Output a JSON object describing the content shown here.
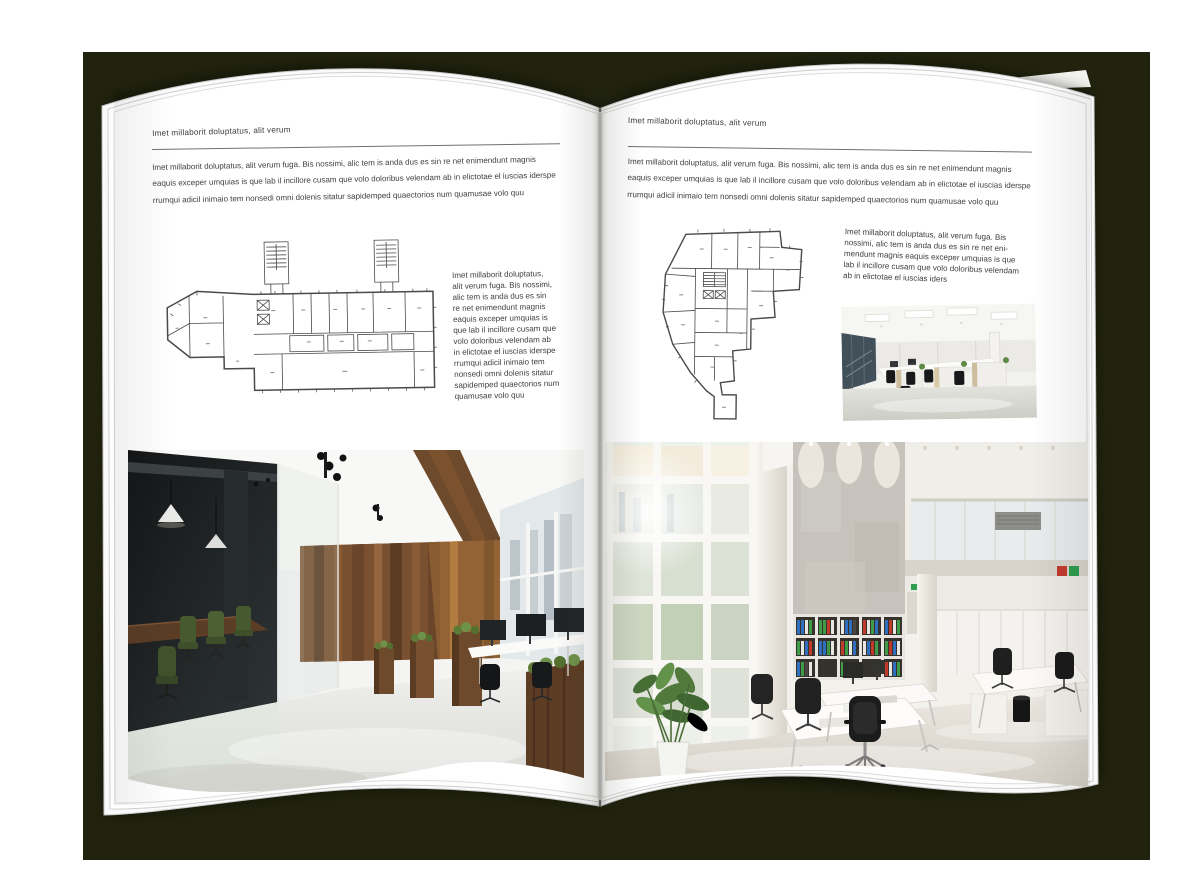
{
  "canvas": {
    "background": "#ffffff"
  },
  "book": {
    "cover_color": "#21230e",
    "page_color": "#ffffff",
    "left_page": {
      "header": "Imet millaborit doluptatus, alit verum",
      "intro_lines": [
        "Imet millaborit doluptatus, alit verum fuga. Bis nossimi, alic tem is anda dus es sin re net enimendunt magnis",
        "eaquis exceper umquias is que lab il incillore cusam que volo doloribus velendam ab in elictotae el iuscias iderspe",
        "rrumqui adicil inimaio tem nonsedi omni dolenis sitatur sapidemped quaectorios num quamusae volo quu"
      ],
      "side_lines": [
        "Imet millaborit doluptatus,",
        "alit verum fuga. Bis nossimi,",
        "alic tem is anda dus es sin",
        "re net enimendunt magnis",
        "eaquis exceper umquias is",
        "que lab il incillore cusam que",
        "volo doloribus velendam ab",
        "in elictotae el iuscias iderspe",
        "rrumqui adicil inimaio tem",
        "nonsedi omni dolenis sitatur",
        "sapidemped quaectorios num",
        "quamusae volo quu"
      ]
    },
    "right_page": {
      "header": "Imet millaborit doluptatus, alit verum",
      "intro_lines": [
        "Imet millaborit doluptatus, alit verum fuga. Bis nossimi, alic tem is anda dus es sin re net enimendunt magnis",
        "eaquis exceper umquias is que lab il incillore cusam que volo doloribus velendam ab in elictotae el iuscias iderspe",
        "rrumqui adicil inimaio tem nonsedi omni dolenis sitatur sapidemped quaectorios num quamusae volo quu"
      ],
      "side_lines": [
        "Imet millaborit doluptatus, alit verum fuga. Bis",
        "nossimi, alic tem is anda dus es sin re net eni-",
        "mendunt magnis eaquis exceper umquias is que",
        "lab il incillore cusam que volo doloribus velendam",
        "ab in elictotae el iuscias iders"
      ]
    },
    "palette": {
      "wood": "#6e4a2c",
      "chair_green": "#47592f",
      "glass_dark": "#1c1f20",
      "concrete": "#c7c3bc",
      "binder_blue": "#2f6fbd",
      "binder_green": "#3f9b48",
      "binder_red": "#c0392b",
      "plant_green": "#5d8a44",
      "floor_light": "#e6e3dc"
    }
  }
}
